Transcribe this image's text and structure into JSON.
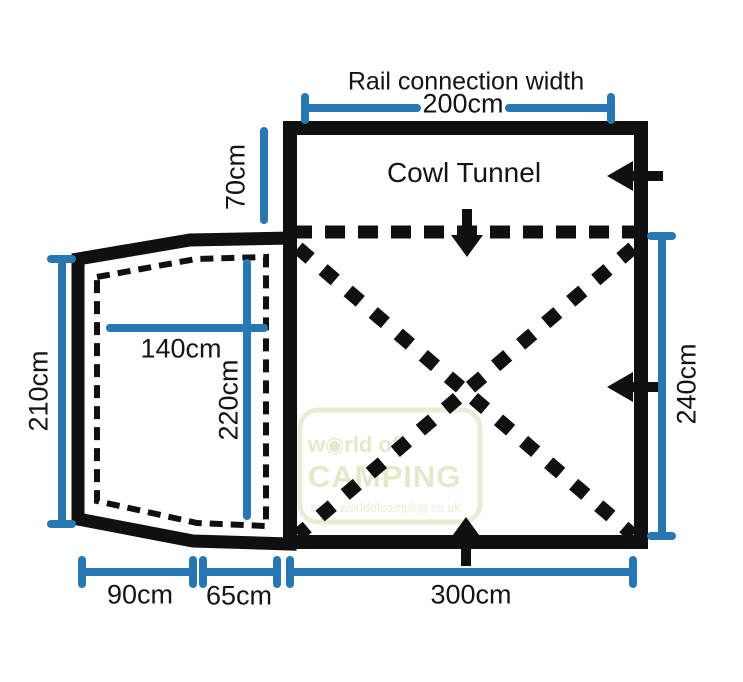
{
  "diagram": {
    "labels": {
      "rail_connection": "Rail connection width",
      "cowl_tunnel": "Cowl Tunnel"
    },
    "dimensions": {
      "rail_connection_width": "200cm",
      "cowl_tunnel_depth": "70cm",
      "annexe_outer_height": "210cm",
      "annexe_inner_width": "140cm",
      "annexe_inner_depth": "220cm",
      "main_depth": "240cm",
      "annexe_bottom_width": "90cm",
      "connector_bottom_width": "65cm",
      "main_bottom_width": "300cm"
    },
    "watermark": {
      "line1": "w◉rld of",
      "line2": "CAMPING",
      "line3": "www.worldofcamping.co.uk"
    },
    "icons": [
      "arrow-left-upper",
      "arrow-left-lower",
      "arrow-down-top",
      "arrow-up-bottom"
    ],
    "colors": {
      "outline_black": "#101010",
      "dimension_blue": "#2677b2",
      "watermark_green": "#e3eacb"
    }
  }
}
